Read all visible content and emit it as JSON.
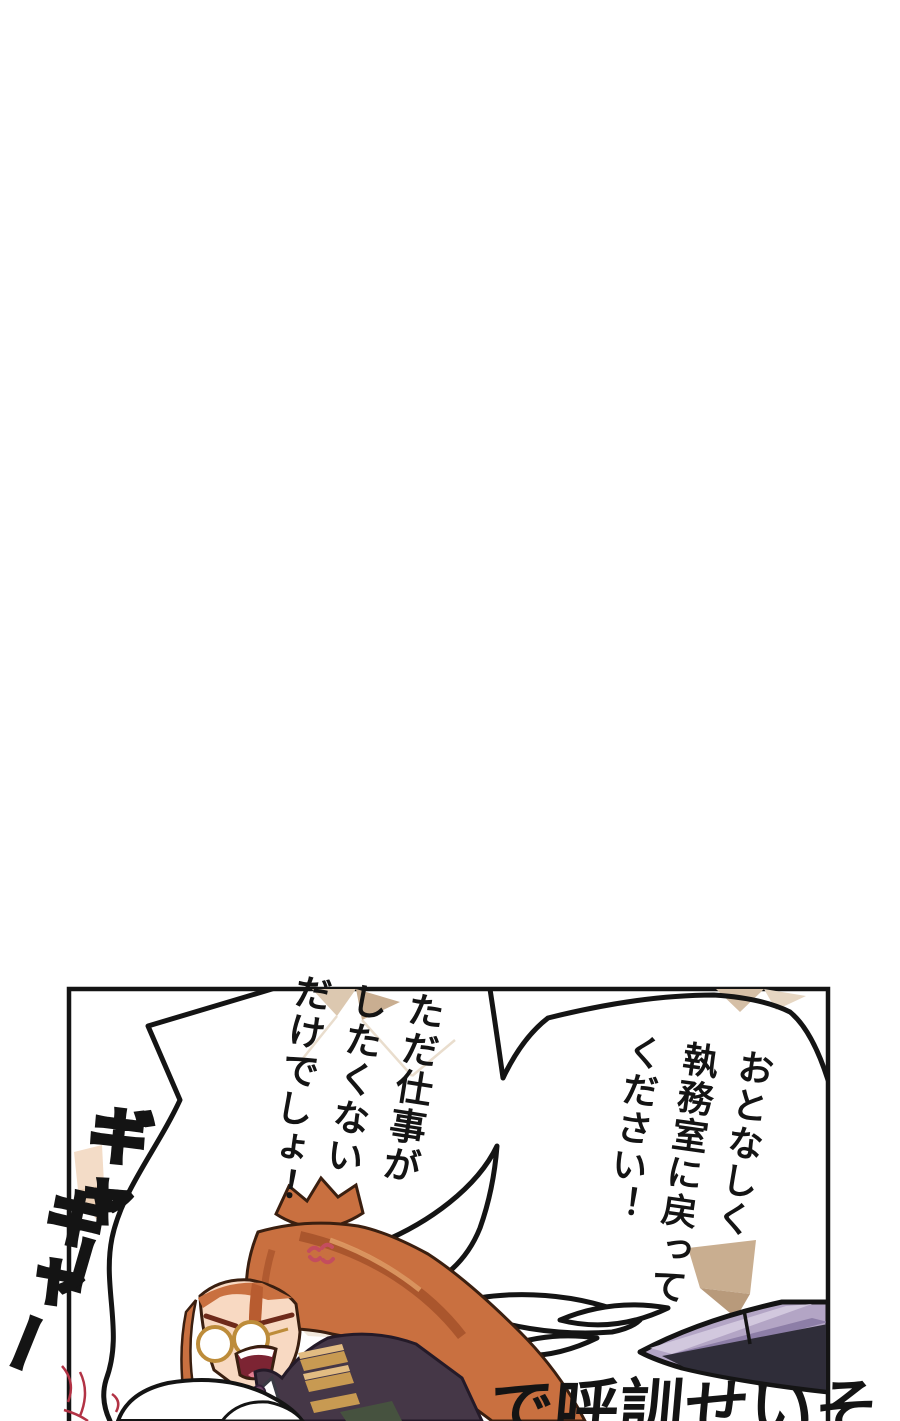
{
  "scene": {
    "type": "manga-panel-page",
    "background_color": "#ffffff",
    "panel_border_color": "#141414"
  },
  "bubbles": {
    "right": {
      "lines": [
        "おとなしく",
        "執務室に戻って",
        "ください！"
      ]
    },
    "left": {
      "lines": [
        "ただ仕事が",
        "したくない",
        "だけでしょ！"
      ]
    }
  },
  "sfx": [
    {
      "text": "ギャー"
    },
    {
      "text": "ギャー"
    }
  ],
  "bottom_text": {
    "text": "で呼訓せいそ"
  },
  "palette": {
    "hair": "#c97040",
    "hair_shadow": "#a5512a",
    "hair_highlight": "#de9a64",
    "skin": "#f8d9c2",
    "jacket": "#453747",
    "jacket_stripe": "#c89a52",
    "jacket_stripe_light": "#e2bc82",
    "collar_green": "#46523f",
    "shirt": "#ffffff",
    "brooch": "#6b4263",
    "glasses_rim": "#bd8c3a",
    "mouth": "#7c2433",
    "tongue": "#e27f92",
    "anger_mark": "#c44d5e",
    "facet_tan": "#c9ae91",
    "facet_tan_light": "#dcc8b0",
    "facet_peach": "#f3dcc7",
    "object_lavender": "#b3a5c5",
    "object_lavender_light": "#d2c8de",
    "object_dark": "#2f2d39",
    "scribble_red": "#b23345"
  }
}
